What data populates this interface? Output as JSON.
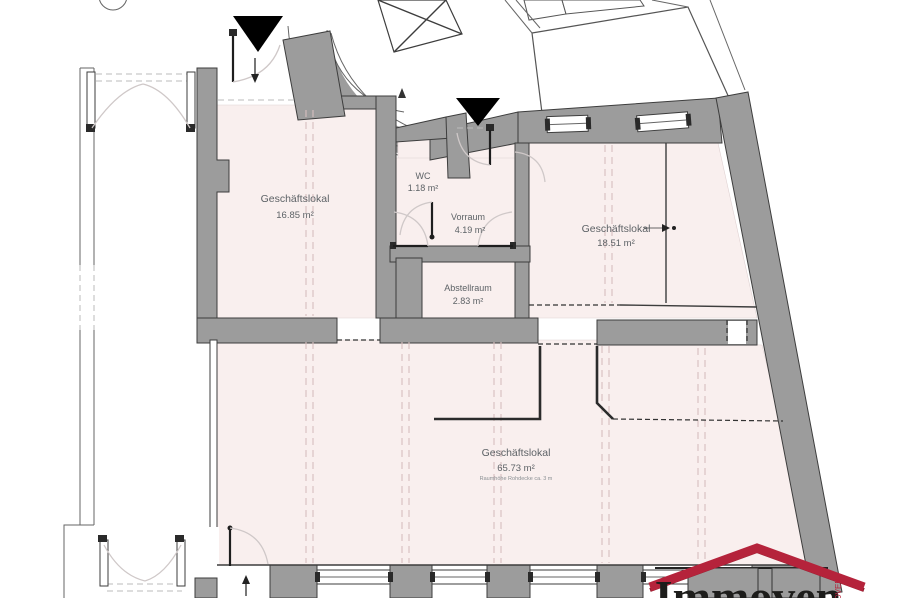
{
  "rooms": [
    {
      "name": "Geschäftslokal",
      "area": "16.85 m²"
    },
    {
      "name": "WC",
      "area": "1.18 m²"
    },
    {
      "name": "Vorraum",
      "area": "4.19 m²"
    },
    {
      "name": "Abstellraum",
      "area": "2.83 m²"
    },
    {
      "name": "Geschäftslokal",
      "area": "18.51 m²"
    },
    {
      "name": "Geschäftslokal",
      "area": "65.73 m²",
      "note": "Raumhöhe Rohdecke ca. 3 m"
    }
  ],
  "logo": {
    "text": "Immoven",
    "vertical_text": "IMMOVEN"
  },
  "colors": {
    "room_fill": "#f9efee",
    "wall_fill": "#9c9c9c",
    "wall_stroke": "#3d3d3d",
    "beam_dash": "#d8bfbf",
    "logo_red": "#b5233b",
    "logo_text": "#1d1d1b"
  }
}
